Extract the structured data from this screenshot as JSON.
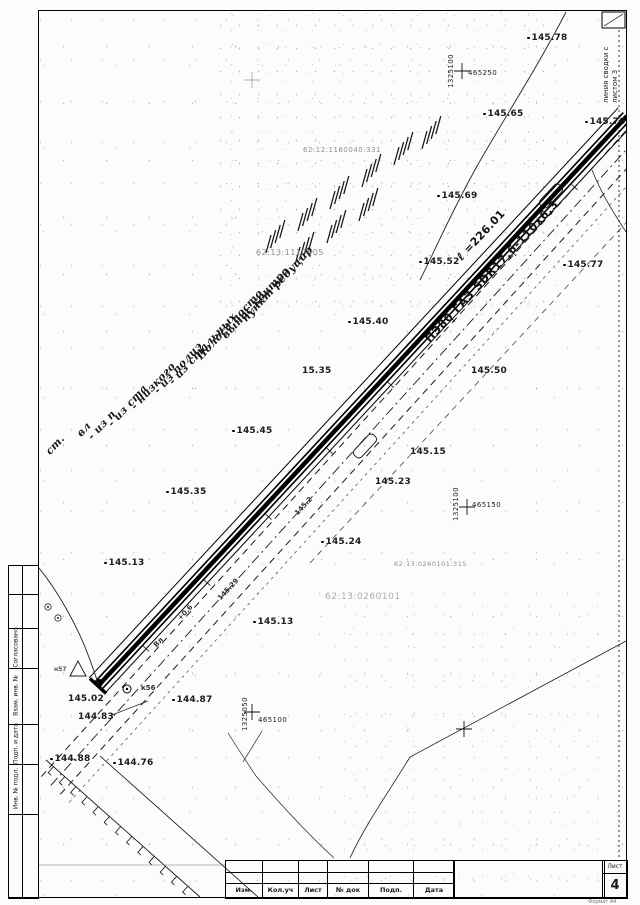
{
  "frame": {
    "corner_mark": "2Е У",
    "match_line": {
      "line1": "линия сводки с",
      "line2": "листом 3"
    },
    "side_strip": {
      "approved": "Согласовано",
      "replace": "Взам. инв. №",
      "sign_date": "Подп. и дата",
      "inv_no": "Инв. № подл."
    },
    "titleblock": {
      "columns": [
        "Изм.",
        "Кол.уч",
        "Лист",
        "№ док",
        "Подп.",
        "Дата"
      ],
      "sheet_word": "Лист",
      "sheet_number": "4",
      "format_note": "Формат А4"
    }
  },
  "map": {
    "pipeline": {
      "spec": "ПЭ80 ГАЗ SDR17,6-110х6,3",
      "length": "ℓ =226.01"
    },
    "elevations": [
      "145.78",
      "145.65",
      "145.69",
      "145.52",
      "145.77",
      "145.40",
      "15.35",
      "145.45",
      "145.50",
      "145.15",
      "145.35",
      "145.23",
      "145.13",
      "145.24",
      "145.13",
      "145.02",
      "144.87",
      "144.83",
      "144.88",
      "144.76",
      "145.76"
    ],
    "grid": {
      "v1": "1325100",
      "h1": "465250",
      "v2": "1325100",
      "h2": "465150",
      "v3": "1325050",
      "h3": "465100"
    },
    "cadastral": [
      "62:12:1160040:331",
      "62:13:1110505",
      "62:13:0260101:315",
      "62:13:0260101"
    ],
    "callouts": [
      "пункт редуцир",
      "вынос контро",
      "Полоса посто",
      "- из стальных",
      "- из полиэ",
      "- низкого",
      "- из ста",
      "- из п",
      "вл",
      "ст."
    ],
    "marks": {
      "k56": "к56",
      "n57": "н57",
      "vl": "Вл",
      "grade": "+0.6",
      "road1": "145.29",
      "road2": "145.2"
    }
  }
}
